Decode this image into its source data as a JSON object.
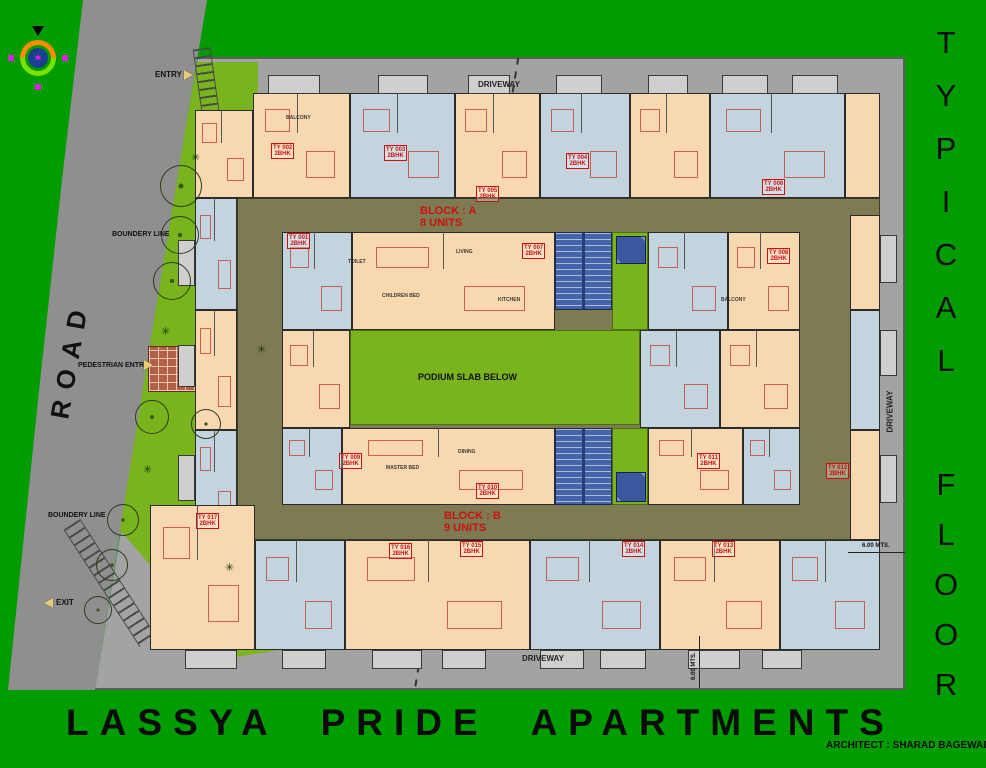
{
  "title": {
    "main": "LASSYA  PRIDE  APARTMENTS",
    "architect": "ARCHITECT : SHARAD BAGEWADI"
  },
  "side_title": {
    "word1": "TYPICAL",
    "word2": "FLOOR"
  },
  "labels": {
    "road": "ROAD",
    "driveway_top": "DRIVEWAY",
    "driveway_bottom": "DRIVEWAY",
    "driveway_right": "DRIVEWAY",
    "entry": "ENTRY",
    "exit": "EXIT",
    "pedestrian_entry": "PEDESTRIAN ENTRY",
    "boundary_line_1": "BOUNDERY LINE",
    "boundary_line_2": "BOUNDERY LINE",
    "podium": "PODIUM SLAB BELOW",
    "dim_right": "6.00 MTS.",
    "dim_bottom": "6.00 MTS."
  },
  "blocks": {
    "a_line1": "BLOCK : A",
    "a_line2": "8 UNITS",
    "b_line1": "BLOCK : B",
    "b_line2": "9 UNITS"
  },
  "colors": {
    "bg_green": "#009c00",
    "lawn_green": "#7ab41d",
    "road_gray": "#8f8f8f",
    "driveway_gray": "#a3a3a3",
    "corridor_olive": "#7e7a52",
    "unit_peach": "#f7d8b1",
    "unit_blue": "#c4d4de",
    "stair_blue": "#4565ab",
    "balcony_gray": "#cfcfcf",
    "label_red": "#cc1111",
    "path_brick": "#b06046"
  },
  "units": [
    {
      "x": 253,
      "y": 93,
      "w": 97,
      "h": 105,
      "c": "unit_peach"
    },
    {
      "x": 350,
      "y": 93,
      "w": 105,
      "h": 105,
      "c": "unit_blue"
    },
    {
      "x": 455,
      "y": 93,
      "w": 85,
      "h": 105,
      "c": "unit_peach"
    },
    {
      "x": 540,
      "y": 93,
      "w": 90,
      "h": 105,
      "c": "unit_blue"
    },
    {
      "x": 630,
      "y": 93,
      "w": 80,
      "h": 105,
      "c": "unit_peach"
    },
    {
      "x": 710,
      "y": 93,
      "w": 135,
      "h": 105,
      "c": "unit_blue"
    },
    {
      "x": 845,
      "y": 93,
      "w": 35,
      "h": 105,
      "c": "unit_peach"
    },
    {
      "x": 195,
      "y": 110,
      "w": 58,
      "h": 88,
      "c": "unit_peach"
    },
    {
      "x": 195,
      "y": 198,
      "w": 42,
      "h": 112,
      "c": "unit_blue"
    },
    {
      "x": 195,
      "y": 310,
      "w": 42,
      "h": 120,
      "c": "unit_peach"
    },
    {
      "x": 195,
      "y": 430,
      "w": 42,
      "h": 110,
      "c": "unit_blue"
    },
    {
      "x": 850,
      "y": 215,
      "w": 30,
      "h": 95,
      "c": "unit_peach"
    },
    {
      "x": 850,
      "y": 310,
      "w": 30,
      "h": 120,
      "c": "unit_blue"
    },
    {
      "x": 850,
      "y": 430,
      "w": 30,
      "h": 110,
      "c": "unit_peach"
    },
    {
      "x": 282,
      "y": 232,
      "w": 70,
      "h": 98,
      "c": "unit_blue"
    },
    {
      "x": 352,
      "y": 232,
      "w": 203,
      "h": 98,
      "c": "unit_peach"
    },
    {
      "x": 648,
      "y": 232,
      "w": 80,
      "h": 98,
      "c": "unit_blue"
    },
    {
      "x": 728,
      "y": 232,
      "w": 72,
      "h": 98,
      "c": "unit_peach"
    },
    {
      "x": 282,
      "y": 330,
      "w": 68,
      "h": 98,
      "c": "unit_peach"
    },
    {
      "x": 640,
      "y": 330,
      "w": 80,
      "h": 98,
      "c": "unit_blue"
    },
    {
      "x": 720,
      "y": 330,
      "w": 80,
      "h": 98,
      "c": "unit_peach"
    },
    {
      "x": 282,
      "y": 428,
      "w": 60,
      "h": 77,
      "c": "unit_blue"
    },
    {
      "x": 342,
      "y": 428,
      "w": 213,
      "h": 77,
      "c": "unit_peach"
    },
    {
      "x": 648,
      "y": 428,
      "w": 95,
      "h": 77,
      "c": "unit_peach"
    },
    {
      "x": 743,
      "y": 428,
      "w": 57,
      "h": 77,
      "c": "unit_blue"
    },
    {
      "x": 150,
      "y": 505,
      "w": 105,
      "h": 145,
      "c": "unit_peach"
    },
    {
      "x": 255,
      "y": 540,
      "w": 90,
      "h": 110,
      "c": "unit_blue"
    },
    {
      "x": 345,
      "y": 540,
      "w": 185,
      "h": 110,
      "c": "unit_peach"
    },
    {
      "x": 530,
      "y": 540,
      "w": 130,
      "h": 110,
      "c": "unit_blue"
    },
    {
      "x": 660,
      "y": 540,
      "w": 120,
      "h": 110,
      "c": "unit_peach"
    },
    {
      "x": 780,
      "y": 540,
      "w": 100,
      "h": 110,
      "c": "unit_blue"
    }
  ],
  "unit_labels": [
    {
      "t": "TY 001",
      "s": "2BHK",
      "x": 303,
      "y": 240
    },
    {
      "t": "TY 002",
      "s": "2BHK",
      "x": 287,
      "y": 150
    },
    {
      "t": "TY 003",
      "s": "2BHK",
      "x": 400,
      "y": 152
    },
    {
      "t": "TY 004",
      "s": "2BHK",
      "x": 582,
      "y": 160
    },
    {
      "t": "TY 005",
      "s": "2BHK",
      "x": 492,
      "y": 193
    },
    {
      "t": "TY 006",
      "s": "2BHK",
      "x": 778,
      "y": 186
    },
    {
      "t": "TY 007",
      "s": "2BHK",
      "x": 538,
      "y": 250
    },
    {
      "t": "TY 008",
      "s": "2BHK",
      "x": 783,
      "y": 255
    },
    {
      "t": "TY 009",
      "s": "2BHK",
      "x": 355,
      "y": 460
    },
    {
      "t": "TY 010",
      "s": "2BHK",
      "x": 492,
      "y": 490
    },
    {
      "t": "TY 011",
      "s": "2BHK",
      "x": 713,
      "y": 460
    },
    {
      "t": "TY 012",
      "s": "2BHK",
      "x": 842,
      "y": 470
    },
    {
      "t": "TY 013",
      "s": "2BHK",
      "x": 728,
      "y": 548
    },
    {
      "t": "TY 014",
      "s": "2BHK",
      "x": 638,
      "y": 548
    },
    {
      "t": "TY 015",
      "s": "2BHK",
      "x": 476,
      "y": 548
    },
    {
      "t": "TY 016",
      "s": "2BHK",
      "x": 405,
      "y": 550
    },
    {
      "t": "TY 017",
      "s": "2BHK",
      "x": 212,
      "y": 520
    }
  ],
  "room_labels": [
    {
      "t": "BALCONY",
      "x": 300,
      "y": 118
    },
    {
      "t": "LIVING",
      "x": 470,
      "y": 252
    },
    {
      "t": "KITCHEN",
      "x": 512,
      "y": 300
    },
    {
      "t": "CHILDREN BED",
      "x": 396,
      "y": 296
    },
    {
      "t": "TOILET",
      "x": 362,
      "y": 262
    },
    {
      "t": "MASTER BED",
      "x": 400,
      "y": 468
    },
    {
      "t": "DINING",
      "x": 472,
      "y": 452
    },
    {
      "t": "BALCONY",
      "x": 735,
      "y": 300
    }
  ],
  "trees": [
    {
      "x": 181,
      "y": 186,
      "r": 21
    },
    {
      "x": 180,
      "y": 235,
      "r": 19
    },
    {
      "x": 172,
      "y": 281,
      "r": 19
    },
    {
      "x": 152,
      "y": 417,
      "r": 17
    },
    {
      "x": 206,
      "y": 424,
      "r": 15
    },
    {
      "x": 123,
      "y": 520,
      "r": 16
    },
    {
      "x": 112,
      "y": 565,
      "r": 16
    },
    {
      "x": 98,
      "y": 610,
      "r": 14
    }
  ],
  "shrubs": [
    {
      "x": 196,
      "y": 158
    },
    {
      "x": 166,
      "y": 332
    },
    {
      "x": 262,
      "y": 350
    },
    {
      "x": 230,
      "y": 568
    },
    {
      "x": 148,
      "y": 470
    }
  ],
  "balconies": [
    {
      "x": 268,
      "y": 75,
      "w": 52,
      "h": 19
    },
    {
      "x": 378,
      "y": 75,
      "w": 50,
      "h": 19
    },
    {
      "x": 468,
      "y": 75,
      "w": 42,
      "h": 19
    },
    {
      "x": 556,
      "y": 75,
      "w": 46,
      "h": 19
    },
    {
      "x": 648,
      "y": 75,
      "w": 40,
      "h": 19
    },
    {
      "x": 722,
      "y": 75,
      "w": 46,
      "h": 19
    },
    {
      "x": 792,
      "y": 75,
      "w": 46,
      "h": 19
    },
    {
      "x": 185,
      "y": 650,
      "w": 52,
      "h": 19
    },
    {
      "x": 282,
      "y": 650,
      "w": 44,
      "h": 19
    },
    {
      "x": 372,
      "y": 650,
      "w": 50,
      "h": 19
    },
    {
      "x": 442,
      "y": 650,
      "w": 44,
      "h": 19
    },
    {
      "x": 540,
      "y": 650,
      "w": 44,
      "h": 19
    },
    {
      "x": 600,
      "y": 650,
      "w": 46,
      "h": 19
    },
    {
      "x": 688,
      "y": 650,
      "w": 52,
      "h": 19
    },
    {
      "x": 762,
      "y": 650,
      "w": 40,
      "h": 19
    },
    {
      "x": 880,
      "y": 235,
      "w": 17,
      "h": 48
    },
    {
      "x": 880,
      "y": 330,
      "w": 17,
      "h": 46
    },
    {
      "x": 880,
      "y": 455,
      "w": 17,
      "h": 48
    },
    {
      "x": 178,
      "y": 240,
      "w": 17,
      "h": 46
    },
    {
      "x": 178,
      "y": 345,
      "w": 17,
      "h": 42
    },
    {
      "x": 178,
      "y": 455,
      "w": 17,
      "h": 46
    }
  ],
  "stairs": [
    {
      "x": 555,
      "y": 232,
      "w": 57,
      "h": 78
    },
    {
      "x": 555,
      "y": 428,
      "w": 57,
      "h": 77
    }
  ],
  "lifts": [
    {
      "x": 616,
      "y": 236,
      "w": 30,
      "h": 28
    },
    {
      "x": 616,
      "y": 472,
      "w": 30,
      "h": 30
    }
  ],
  "courtyard": {
    "x": 350,
    "y": 330,
    "w": 290,
    "h": 95
  },
  "pockets": [
    {
      "x": 612,
      "y": 232,
      "w": 36,
      "h": 98
    },
    {
      "x": 612,
      "y": 428,
      "w": 36,
      "h": 77
    }
  ]
}
